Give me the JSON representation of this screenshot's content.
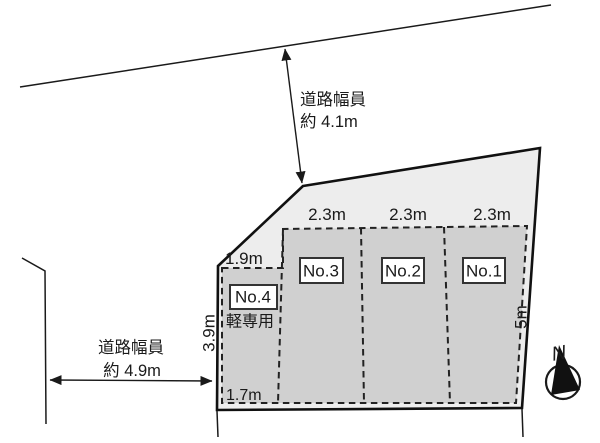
{
  "diagram": {
    "road_top": {
      "name_label": "道路幅員",
      "width_label": "約 4.1m"
    },
    "road_left": {
      "name_label": "道路幅員",
      "width_label": "約 4.9m"
    },
    "stalls": [
      {
        "id": "No.1",
        "width": "2.3m"
      },
      {
        "id": "No.2",
        "width": "2.3m"
      },
      {
        "id": "No.3",
        "width": "2.3m"
      },
      {
        "id": "No.4",
        "width": "1.9m",
        "note": "軽専用"
      }
    ],
    "dims": {
      "left_depth": "3.9m",
      "right_depth": "5m",
      "bottom_width": "1.7m"
    },
    "compass": {
      "north_label": "N"
    }
  },
  "colors": {
    "background": "#ffffff",
    "parcel_fill": "#ededed",
    "stall_fill": "#d0d0d0",
    "line": "#1a1a1a",
    "box_fill": "#ffffff"
  }
}
